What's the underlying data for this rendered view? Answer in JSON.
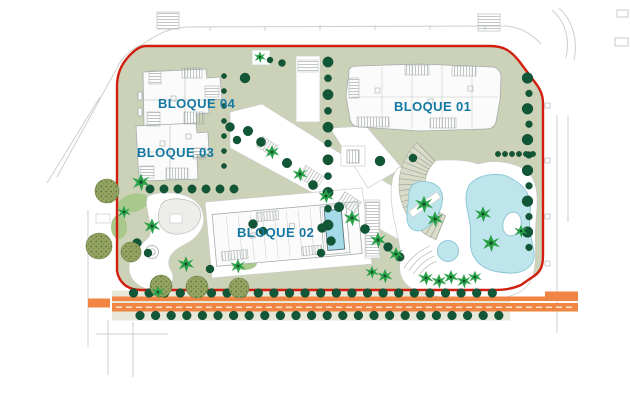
{
  "labels": {
    "b01": "BLOQUE 01",
    "b02": "BLOQUE 02",
    "b03": "BLOQUE 03",
    "b04": "BLOQUE 04"
  },
  "colors": {
    "boundary_red": "#d11e0f",
    "label_teal": "#1478a2",
    "landscape_sage": "#cbd2b8",
    "strip_beige": "#e8e8d8",
    "tree_dark_green": "#115737",
    "palm_green": "#2aa148",
    "olive_tree": "#97a263",
    "pool_blue": "#bfe5ec",
    "pool_edge": "#8fc8d6",
    "rooftop_pool_blue": "#a5dbe8",
    "road_orange": "#f08544",
    "building_fill": "#fafbfa",
    "building_outline": "#a6acac",
    "amphitheater_fill": "#d9dcc8",
    "lawn_light_green": "#a9c98c"
  }
}
